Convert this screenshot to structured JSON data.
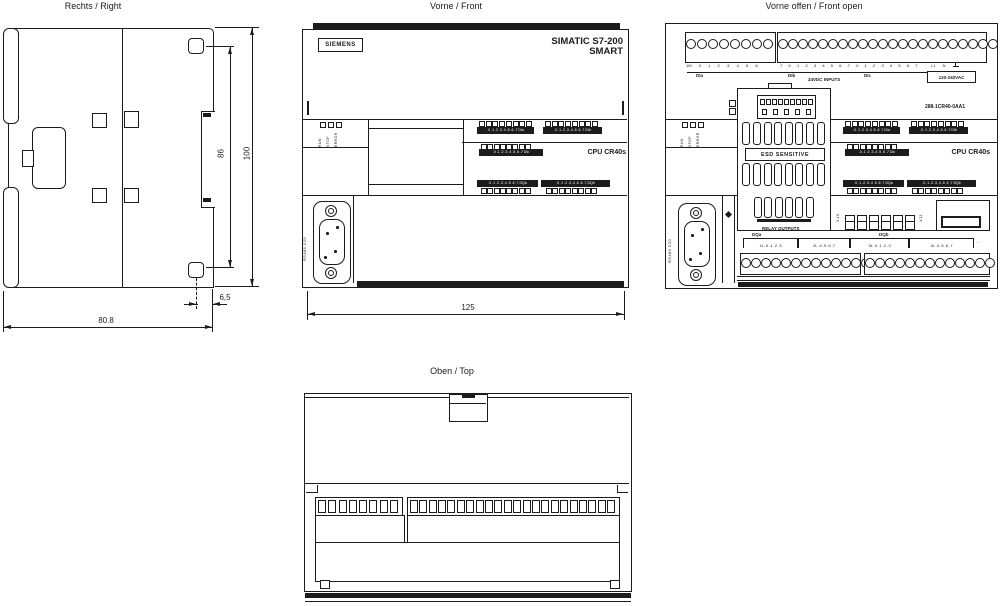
{
  "ink": "#1c1c1c",
  "right_view": {
    "title": "Rechts / Right",
    "dim_hole": "86",
    "dim_height": "100",
    "dim_offset": "6,5",
    "dim_depth": "80.8"
  },
  "front_view": {
    "title": "Vorne / Front",
    "brand": "SIEMENS",
    "product1": "SIMATIC S7-200",
    "product2": "SMART",
    "cpu": "CPU CR40s",
    "port": "RS485 X20",
    "dim_width": "125",
    "status": {
      "run": "RUN",
      "stop": "STOP",
      "error": "ERROR"
    },
    "io": {
      "led_count": 8,
      "bar_dia": ".0 .1 .2 .3 .4 .5 .6 .7  DIa",
      "bar_dib": ".0 .1 .2 .3 .4 .5 .6 .7  DIb",
      "bar_dic": ".0 .1 .2 .3 .4 .5 .6 .7  DIc",
      "bar_dqa": ".0 .1 .2 .3 .4 .5 .6 .7  DQa",
      "bar_dqb": ".0 .1 .2 .3 .4 .5 .6 .7  DQb"
    }
  },
  "open_view": {
    "title": "Vorne offen / Front open",
    "order_no": "288-1CR40-0AA1",
    "esd": "ESD  SENSITIVE",
    "inputs_caption": "24VDC INPUTS",
    "power_caption": "120-240VAC",
    "power_l1": "L1",
    "power_n": "N",
    "terms_left": "1M .0 .1 .2 .3 .4 .5 .6",
    "terms_right": ".7 .0 .1 .2 .3 .4 .5 .6 .7 .0 .1 .2 .3 .4 .5 .6 .7",
    "g_dia": "DIa",
    "g_dib": "DIb",
    "g_dic": "DIc",
    "g_dqa": "DQa",
    "g_dqb": "DQb",
    "relay_caption": "RELAY OUTPUTS",
    "relay_g1": "1L .0 .1 .2 .3",
    "relay_g2": "2L .4 .5 .6 .7",
    "relay_g3": "3L .0 .1 .2 .3",
    "relay_g4": "4L .4 .5 .6 .7",
    "relay_extra": "· ·",
    "x10": "X10",
    "x11": "X11",
    "counts": {
      "top_left_terms": 8,
      "top_right_terms": 22,
      "bottom_left_terms": 14,
      "bottom_right_terms": 13,
      "vent_cols": 8,
      "vent_cols_small": 6,
      "pins_total": 14,
      "jumpers": 6
    }
  },
  "top_view": {
    "title": "Oben / Top"
  }
}
